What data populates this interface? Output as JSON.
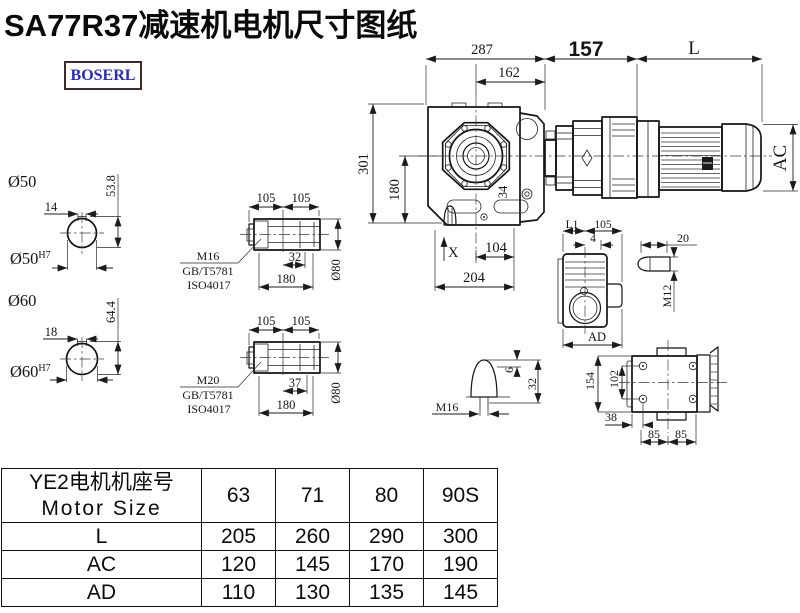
{
  "title": "SA77R37减速机电机尺寸图纸",
  "logo": "BOSERL",
  "main_view": {
    "dim_top_overall": "287",
    "dim_top_inner": "162",
    "dim_adapter": "157",
    "dim_motor_length": "L",
    "dim_motor_diameter": "AC",
    "dim_height_overall": "301",
    "dim_height_center": "180",
    "dim_shaft": "34",
    "dim_bottom_inner": "104",
    "dim_bottom_overall": "204",
    "label_x": "X"
  },
  "shaft_section_50": {
    "label": "Ø50",
    "key_width": "14",
    "key_height": "53.8",
    "bore": "Ø50",
    "bore_tolerance": "H7"
  },
  "shaft_section_60": {
    "label": "Ø60",
    "key_width": "18",
    "key_height": "64.4",
    "bore": "Ø60",
    "bore_tolerance": "H7"
  },
  "hollow_shaft_top": {
    "dim_left": "105",
    "dim_right": "105",
    "dim_bore_depth": "32",
    "dim_length": "180",
    "dim_diameter": "Ø80",
    "thread": "M16",
    "standard_1": "GB/T5781",
    "standard_2": "ISO4017"
  },
  "hollow_shaft_bottom": {
    "dim_left": "105",
    "dim_right": "105",
    "dim_bore_depth": "37",
    "dim_length": "180",
    "dim_diameter": "Ø80",
    "thread": "M20",
    "standard_1": "GB/T5781",
    "standard_2": "ISO4017"
  },
  "plug_detail": {
    "dim_tip": "6",
    "dim_height": "32",
    "thread": "M16"
  },
  "side_view": {
    "dim_l1": "L1",
    "dim_width": "105",
    "dim_offset": "4",
    "dim_ad": "AD"
  },
  "key_detail": {
    "dim_length": "20",
    "thread": "M12"
  },
  "rear_view": {
    "dim_height": "154",
    "dim_hole_spacing": "102",
    "dim_foot": "38",
    "dim_bolt_left": "85",
    "dim_bolt_right": "85"
  },
  "table": {
    "header_line1": "YE2电机机座号",
    "header_line2": "Motor Size",
    "columns": [
      "63",
      "71",
      "80",
      "90S"
    ],
    "rows": [
      {
        "label": "L",
        "values": [
          "205",
          "260",
          "290",
          "300"
        ]
      },
      {
        "label": "AC",
        "values": [
          "120",
          "145",
          "170",
          "190"
        ]
      },
      {
        "label": "AD",
        "values": [
          "110",
          "130",
          "135",
          "145"
        ]
      }
    ]
  }
}
